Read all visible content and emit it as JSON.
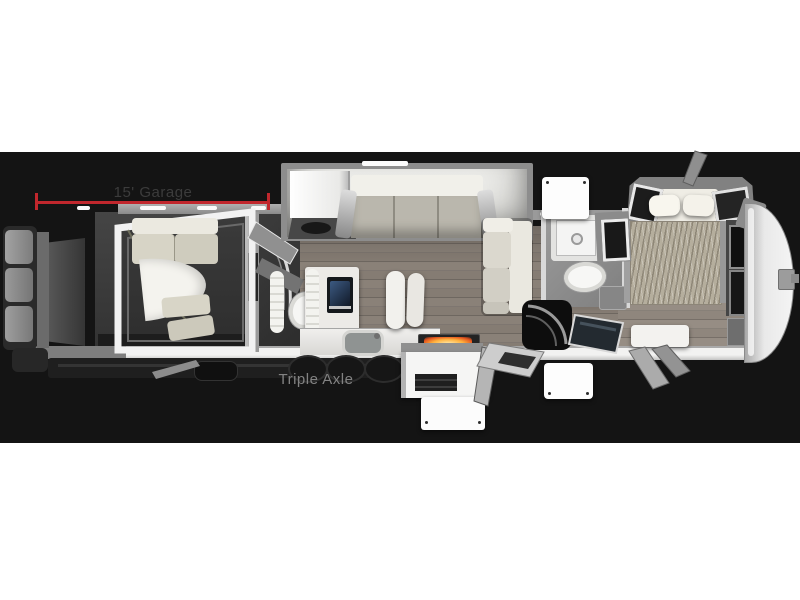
{
  "labels": {
    "garage_dimension": "15' Garage",
    "axle": "Triple Axle"
  },
  "colors": {
    "page_background": "#ffffff",
    "band_background": "#141414",
    "dimension_line_red": "#c1272d",
    "garage_label_text": "#3c3c3c",
    "axle_label_text": "#828282",
    "fireplace_glow_orange": "#ff9a3c",
    "wood_floor": "#857c73",
    "wall_white": "#f2f2f1"
  }
}
